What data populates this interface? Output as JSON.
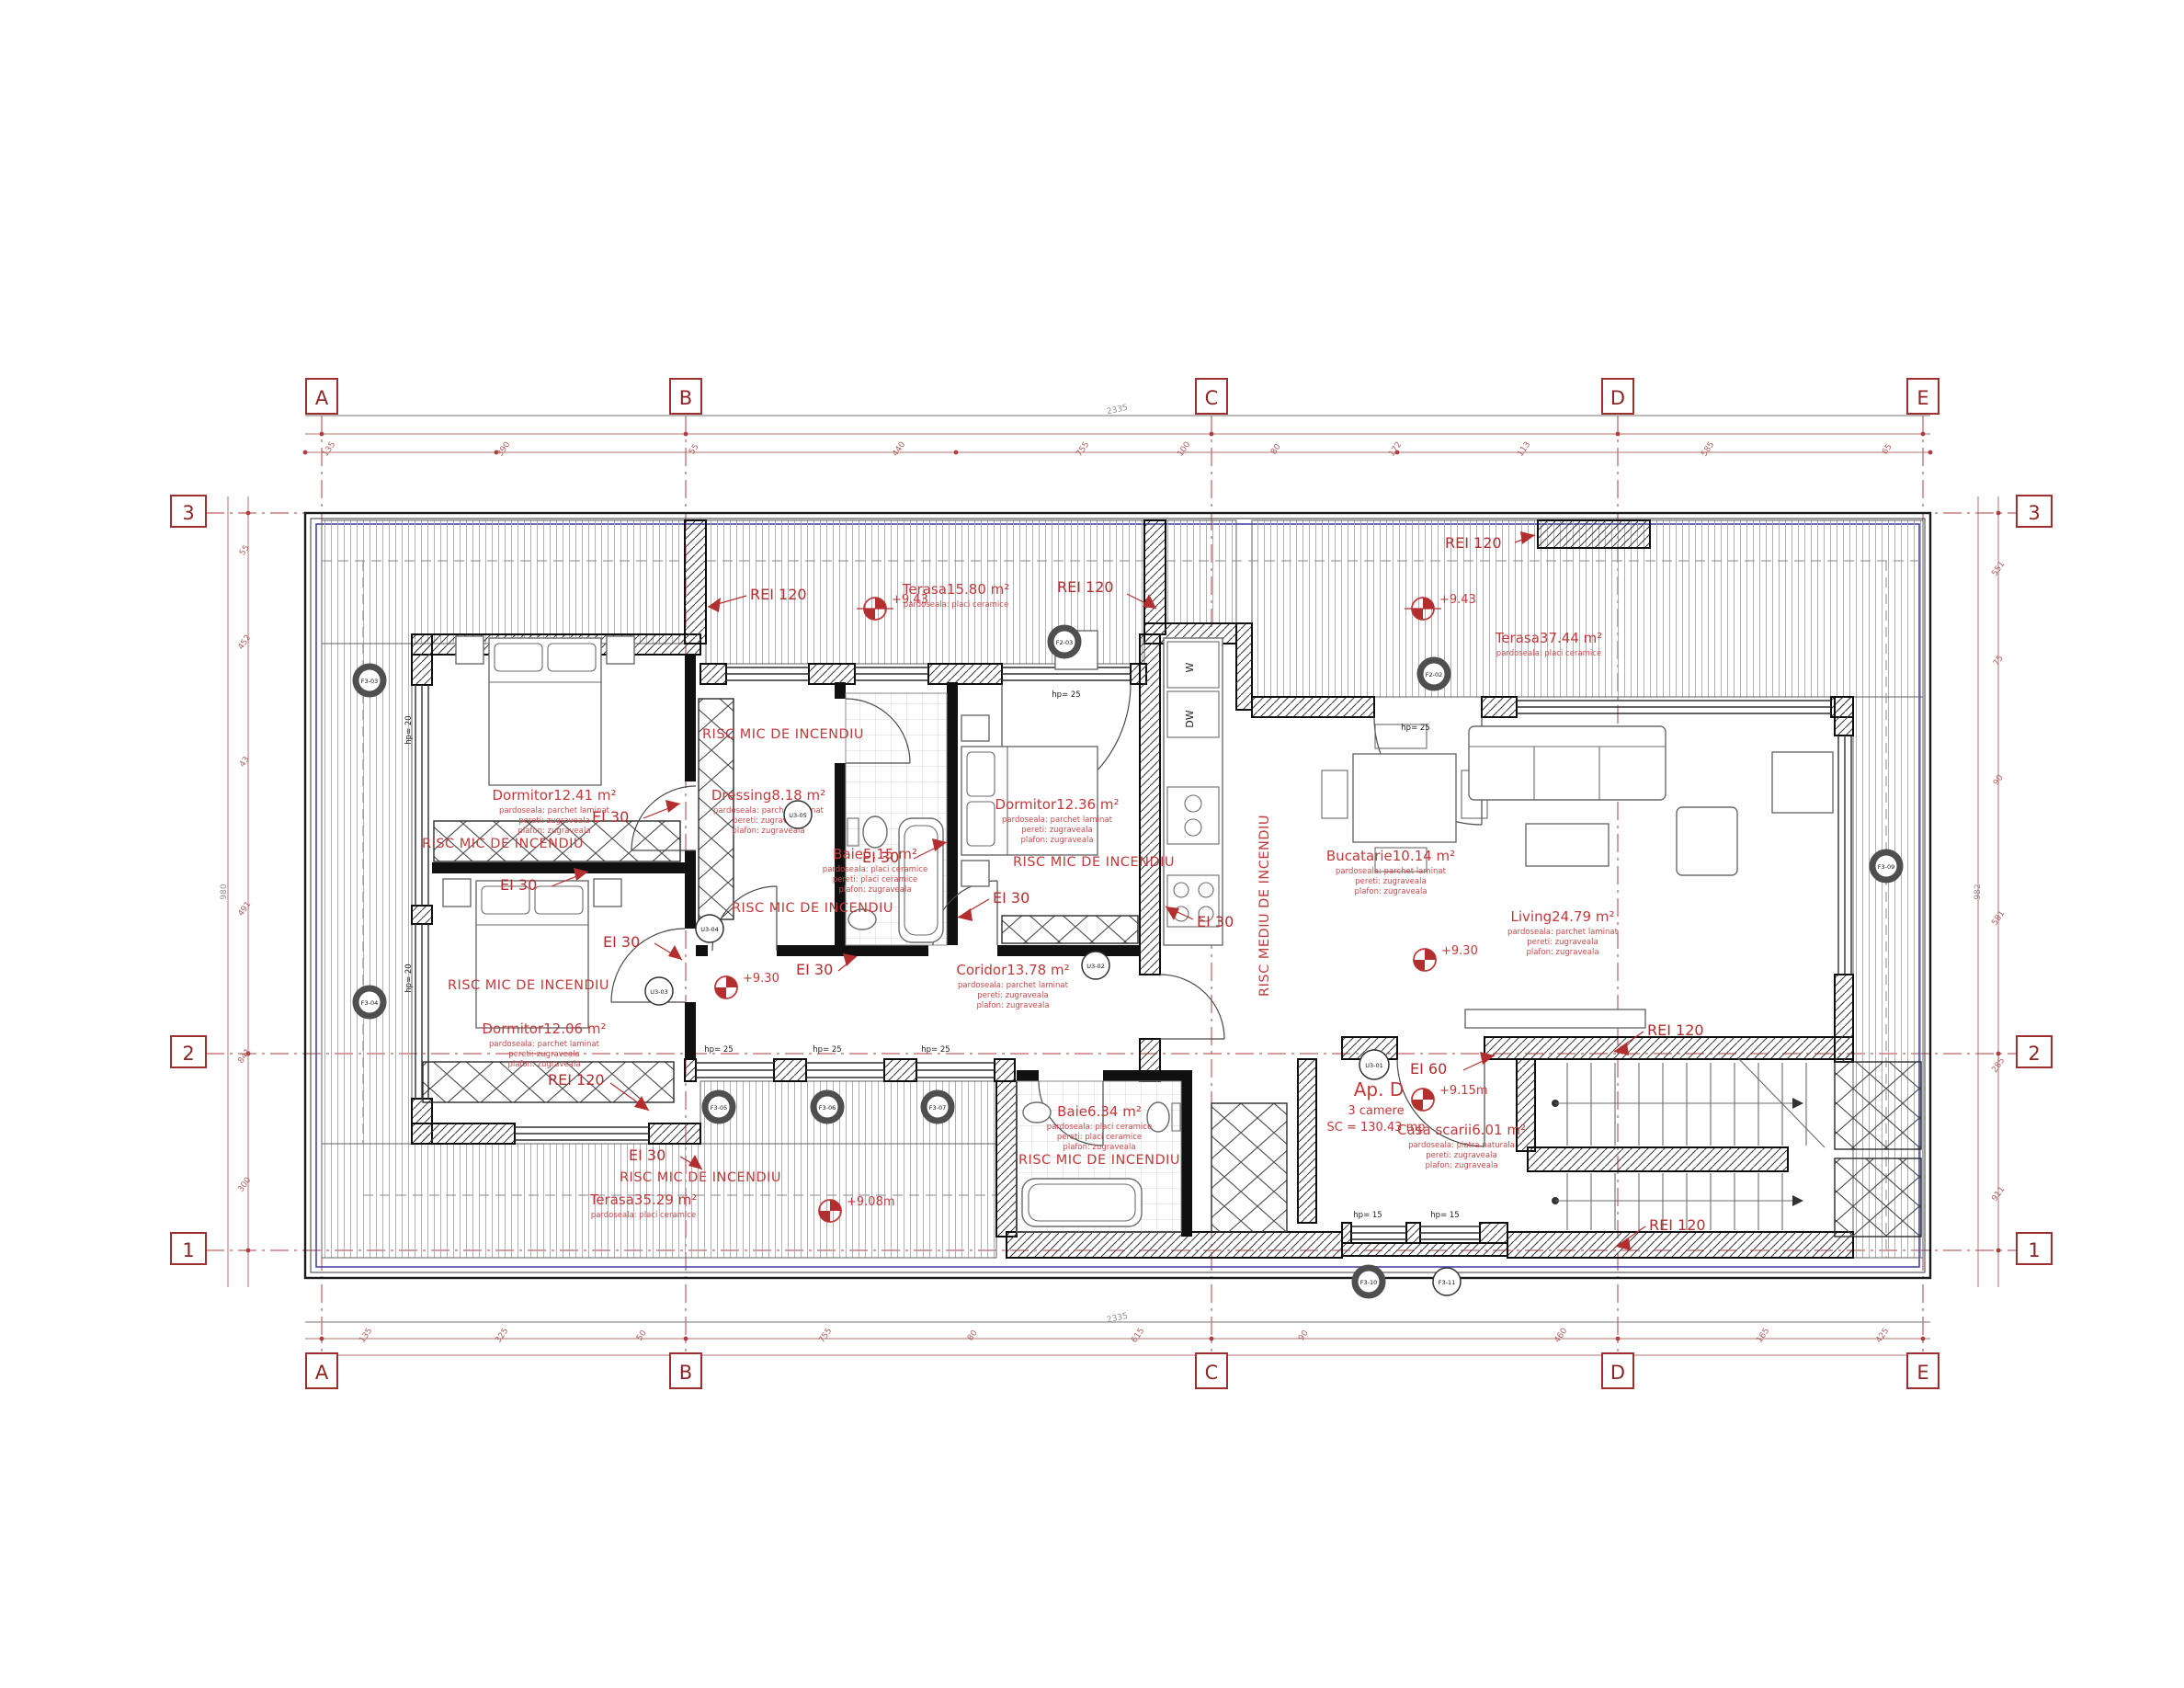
{
  "apartment": {
    "id": "Ap. D",
    "rooms_count": "3 camere",
    "built_area": "SC = 130.43 mp"
  },
  "grid": {
    "cols": [
      "A",
      "B",
      "C",
      "D",
      "E"
    ],
    "rows": [
      "3",
      "2",
      "1"
    ]
  },
  "fire": {
    "risc_mic": "RISC MIC DE INCENDIU",
    "risc_mediu": "RISC MEDIU DE INCENDIU",
    "rei120": "REI 120",
    "ei30": "EI 30",
    "ei60": "EI 60"
  },
  "rooms": {
    "dorm1": {
      "label": "Dormitor12.41 m²",
      "f": [
        "pardoseala: parchet laminat",
        "pereti: zugraveala",
        "plafon: zugraveala"
      ]
    },
    "dorm2": {
      "label": "Dormitor12.06 m²",
      "f": [
        "pardoseala: parchet laminat",
        "pereti: zugraveala",
        "plafon: zugraveala"
      ]
    },
    "dorm3": {
      "label": "Dormitor12.36 m²",
      "f": [
        "pardoseala: parchet laminat",
        "pereti: zugraveala",
        "plafon: zugraveala"
      ]
    },
    "dressing": {
      "label": "Dressing8.18 m²",
      "f": [
        "pardoseala: parchet laminat",
        "pereti: zugraveala",
        "plafon: zugraveala"
      ]
    },
    "baie5": {
      "label": "Baie5.15 m²",
      "f": [
        "pardoseala: placi ceramice",
        "pereti: placi ceramice",
        "plafon: zugraveala"
      ]
    },
    "baie6": {
      "label": "Baie6.34 m²",
      "f": [
        "pardoseala: placi ceramice",
        "pereti: placi ceramice",
        "plafon: zugraveala"
      ]
    },
    "coridor": {
      "label": "Coridor13.78 m²",
      "f": [
        "pardoseala: parchet laminat",
        "pereti: zugraveala",
        "plafon: zugraveala"
      ]
    },
    "bucatarie": {
      "label": "Bucatarie10.14 m²",
      "f": [
        "pardoseala: parchet laminat",
        "pereti: zugraveala",
        "plafon: zugraveala"
      ]
    },
    "living": {
      "label": "Living24.79 m²",
      "f": [
        "pardoseala: parchet laminat",
        "pereti: zugraveala",
        "plafon: zugraveala"
      ]
    },
    "scarii": {
      "label": "Casa scarii6.01 m²",
      "f": [
        "pardoseala: piatra naturala",
        "pereti: zugraveala",
        "plafon: zugraveala"
      ]
    },
    "terasa15": {
      "label": "Terasa15.80 m²",
      "f": [
        "pardoseala: placi ceramice"
      ]
    },
    "terasa37": {
      "label": "Terasa37.44 m²",
      "f": [
        "pardoseala: placi ceramice"
      ]
    },
    "terasa35": {
      "label": "Terasa35.29 m²",
      "f": [
        "pardoseala: placi ceramice"
      ]
    }
  },
  "elevations": {
    "t15": "+9.43",
    "t37": "+9.43",
    "coridor": "+9.30",
    "living": "+9.30",
    "entry": "+9.15m",
    "t35": "+9.08m"
  },
  "markers": {
    "doors": [
      "U3-01",
      "U3-02",
      "U3-03",
      "U3-04",
      "U3-05"
    ],
    "windows": [
      "F2-02",
      "F2-03",
      "F3-03",
      "F3-04",
      "F3-05",
      "F3-06",
      "F3-07",
      "F3-09",
      "F3-10",
      "F3-11"
    ]
  },
  "appliances": {
    "washer": "W",
    "dishwasher": "DW"
  },
  "annotations": {
    "hp25": "hp= 25",
    "hp20": "hp= 20",
    "hp15": "hp= 15"
  },
  "dims": {
    "top_overall": "2335",
    "top": [
      "135",
      "390",
      "55",
      "440",
      "755",
      "100",
      "80",
      "172",
      "113",
      "585",
      "65"
    ],
    "bottom_overall": "2335",
    "bottom": [
      "135",
      "325",
      "50",
      "755",
      "80",
      "615",
      "90",
      "460",
      "165",
      "425"
    ],
    "left_overall": "980",
    "left": [
      "55",
      "452",
      "43",
      "491",
      "841",
      "300"
    ],
    "right_overall": "982",
    "right": [
      "551",
      "75",
      "90",
      "581",
      "285",
      "911"
    ]
  },
  "colors": {
    "annotation_red": "#c23a3a",
    "grid_red": "#9c3030",
    "wall_black": "#101010",
    "blue_line": "#4646a8"
  }
}
